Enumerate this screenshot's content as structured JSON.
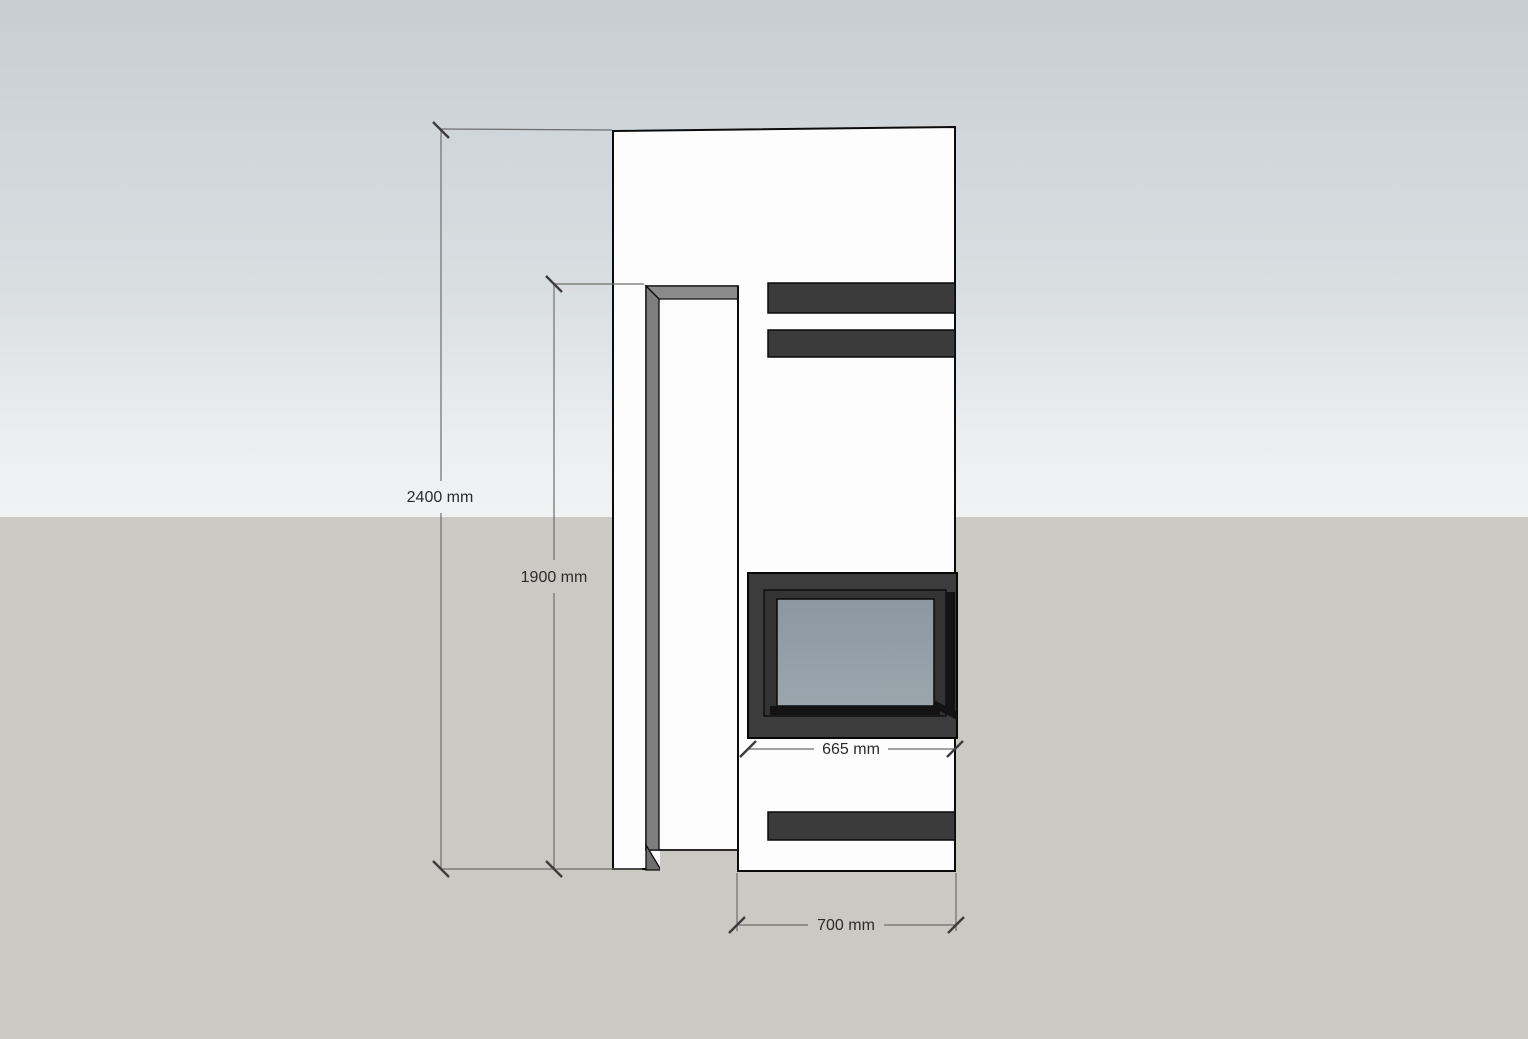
{
  "scene": {
    "background": {
      "sky_top": "#c7ced3",
      "sky_mid": "#d9dee1",
      "sky_low": "#eceef0",
      "sky_horizon": "#f1f2f3",
      "ground": "#cac9c3"
    },
    "model": {
      "body_fill": "#fdfdfd",
      "niche_fill": "#fcfcfc",
      "niche_header_fill": "#8b8b8b",
      "niche_jamb_fill": "#7e7e7e",
      "niche_foot_fill": "#6f6f6f",
      "vent_fill": "#3b3b3c",
      "firebox_surround_fill": "#3c3c3d",
      "firebox_inner_frame_fill": "#333334",
      "firebox_shadow_fill": "#131313",
      "glass_top": "#8c97a0",
      "glass_bottom": "#9ca6ad"
    },
    "dimensions": {
      "line_color": "#6e6e6e",
      "tick_color": "#3c3c3c",
      "text_color": "#2b2b2b",
      "overall_height_label": "2400 mm",
      "niche_height_label": "1900 mm",
      "firebox_width_label": "665 mm",
      "base_width_label": "700 mm"
    }
  }
}
